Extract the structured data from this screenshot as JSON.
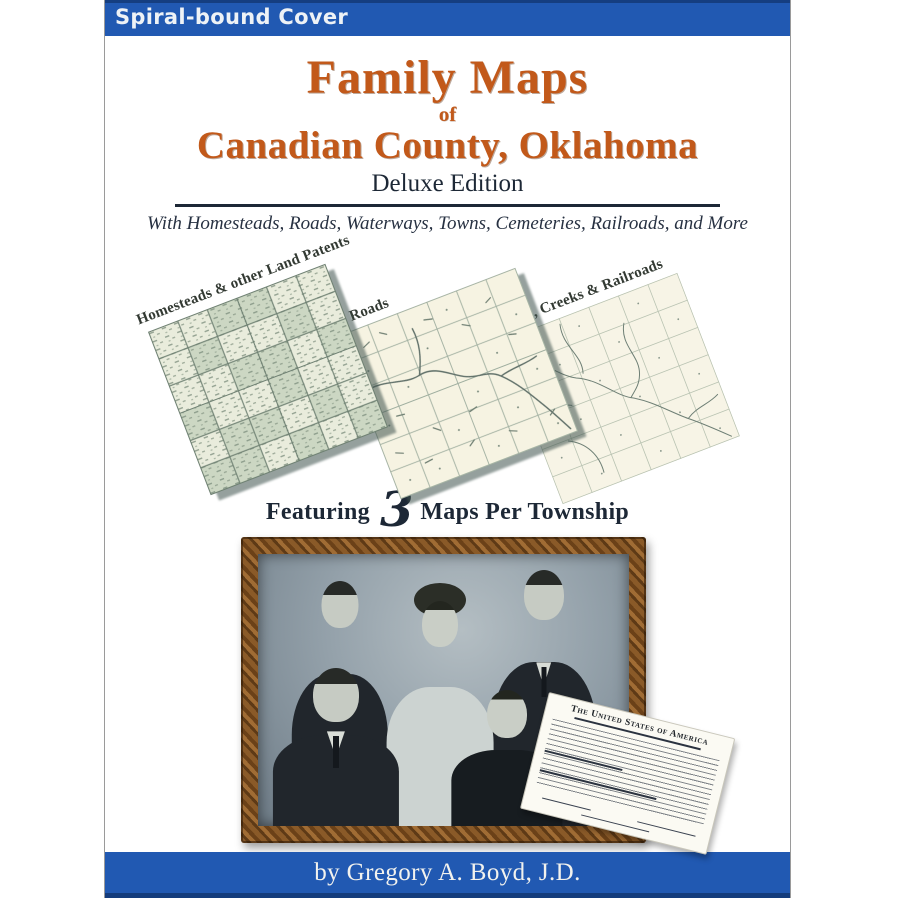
{
  "banner": {
    "label": "Spiral-bound Cover"
  },
  "title": {
    "main": "Family Maps",
    "connector": "of",
    "county": "Canadian County, Oklahoma",
    "edition": "Deluxe Edition",
    "subtitle": "With Homesteads, Roads, Waterways, Towns, Cemeteries, Railroads, and More"
  },
  "maps": {
    "items": [
      {
        "label": "Homesteads & other Land Patents"
      },
      {
        "label": "Roads"
      },
      {
        "label": "Rivers, Creeks & Railroads"
      }
    ],
    "featuring": {
      "prefix": "Featuring",
      "count": "3",
      "suffix": "Maps Per Township"
    }
  },
  "photo": {
    "document_header": "The United States of America"
  },
  "footer": {
    "byline": "by Gregory A. Boyd, J.D."
  },
  "colors": {
    "banner_blue": "#2159b2",
    "banner_edge": "#153e80",
    "title_orange": "#c2591a",
    "dark_navy": "#1d2836",
    "map_sage": "#ccd7c3",
    "map_cream": "#f6f3e2",
    "frame_wood": "#7a4a22"
  }
}
